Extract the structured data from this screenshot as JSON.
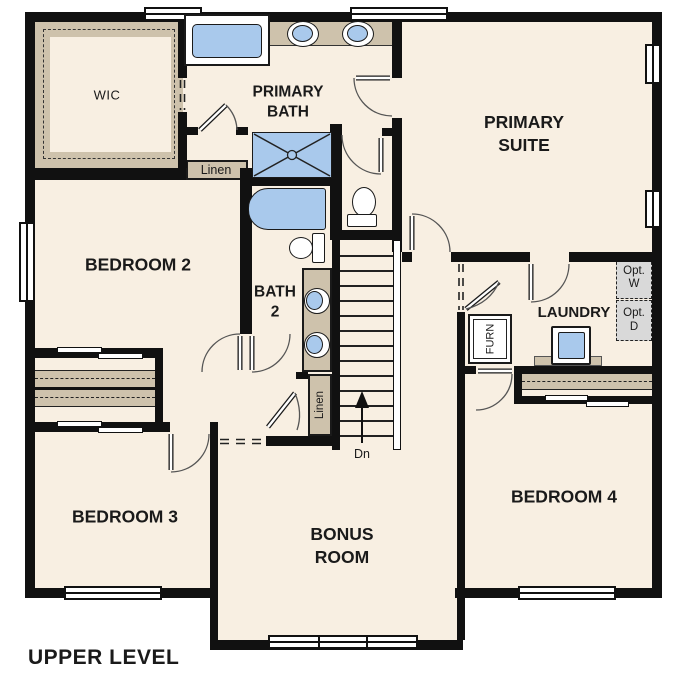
{
  "plan_title": "UPPER LEVEL",
  "rooms": {
    "wic": "WIC",
    "primary_bath": "PRIMARY BATH",
    "primary_suite": "PRIMARY SUITE",
    "bedroom2": "BEDROOM 2",
    "bath2": "BATH 2",
    "laundry": "LAUNDRY",
    "bedroom3": "BEDROOM 3",
    "bonus_room": "BONUS ROOM",
    "bedroom4": "BEDROOM 4"
  },
  "closets": {
    "linen_primary": "Linen",
    "linen_hall": "Linen"
  },
  "equipment": {
    "furnace": "FURN",
    "optional_washer": "Opt. W",
    "optional_dryer": "Opt. D"
  },
  "stairs": {
    "down_label": "Dn"
  },
  "colors": {
    "floor": "#f8efe2",
    "walls": "#111111",
    "fixtures_blue": "#a9c9ec",
    "counters_tan": "#cec2ac",
    "optional_appliance_gray": "#d9d9d9"
  }
}
